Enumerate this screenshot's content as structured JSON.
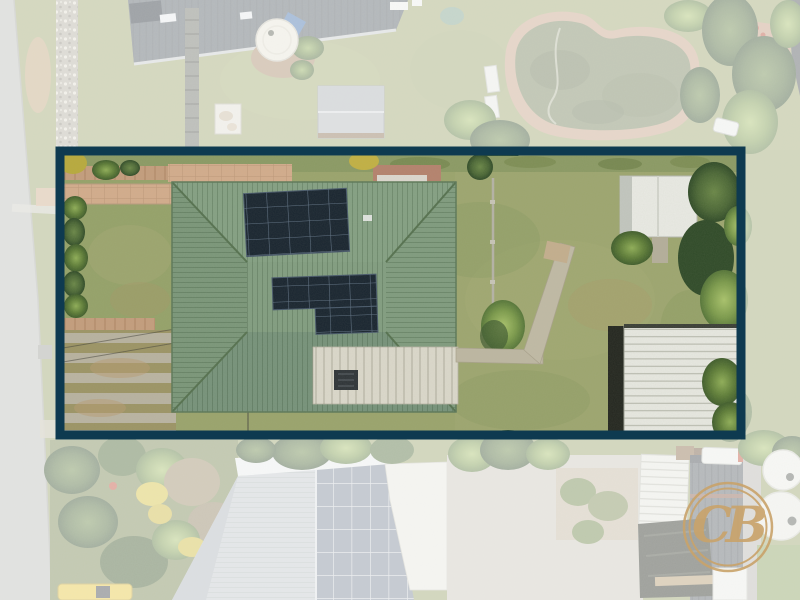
{
  "image_type": "aerial drone photograph of suburban property for real estate listing",
  "watermark": {
    "initials": "CB",
    "ring_color": "#c9a36a"
  },
  "highlight_box": {
    "x": 60,
    "y": 151,
    "width": 681,
    "height": 284,
    "border_color": "#0e3a50",
    "border_width": 9,
    "outside_fade_color": "#ffffff",
    "outside_fade_opacity": 0.56
  },
  "palette": {
    "grass": "#9aa46c",
    "road": "#bdbfba",
    "roof_main_green": "#819d80",
    "roof_flat_white": "#dbd8cb",
    "solar_panel": "#18242f",
    "shed_white": "#e9eae4",
    "garage_shadow": "#23261f",
    "pool_water": "#75815b",
    "pool_surround": "#c7a285",
    "path_tan": "#d3ac8c",
    "concrete_path": "#bdb7a2",
    "neighbor_roof_dark": "#4e5862",
    "neighbor_roof_gray": "#c2c8ce",
    "neighbor_solar": "#7b8798",
    "tarp_black": "#25291f",
    "car_yellow": "#e8c83c"
  },
  "scene": {
    "property": {
      "label": "highlighted property inside navy boundary box",
      "features": [
        "green corrugated hip-roof house",
        "upper rooftop solar array 4 rows x 5 columns",
        "lower L-shaped rooftop solar array",
        "white flat patio roof with dark vent",
        "white garden shed with shrub",
        "white corrugated garage roof bottom right",
        "striped concrete side driveway",
        "tan front path and retaining wall",
        "clothesline and concrete backyard paths",
        "hedge on left boundary and trees on right boundary"
      ],
      "solar_arrays": [
        {
          "position": "upper roof",
          "rows": 4,
          "cols": 5
        },
        {
          "position": "lower roof",
          "shape": "L",
          "upper": {
            "rows": 2,
            "cols": 5
          },
          "lower": {
            "rows": 2,
            "cols": 3
          }
        }
      ]
    },
    "surroundings": [
      "street along left edge with grass verge and pebble strip",
      "top-left neighbor house with dark roof, round water tank, timber walkway and grey shed",
      "kidney-shaped green pool with paved surround at top",
      "dense trees and brick courtyard at top right",
      "garden with yellow flowering shrubs bottom left",
      "yellow car parked at bottom edge",
      "bottom neighbor house with grey roof and large solar array",
      "white flat roof and concrete yard bottom center",
      "bottom-right neighbor with dark metal roof, white van, water tanks and black tarp"
    ]
  }
}
